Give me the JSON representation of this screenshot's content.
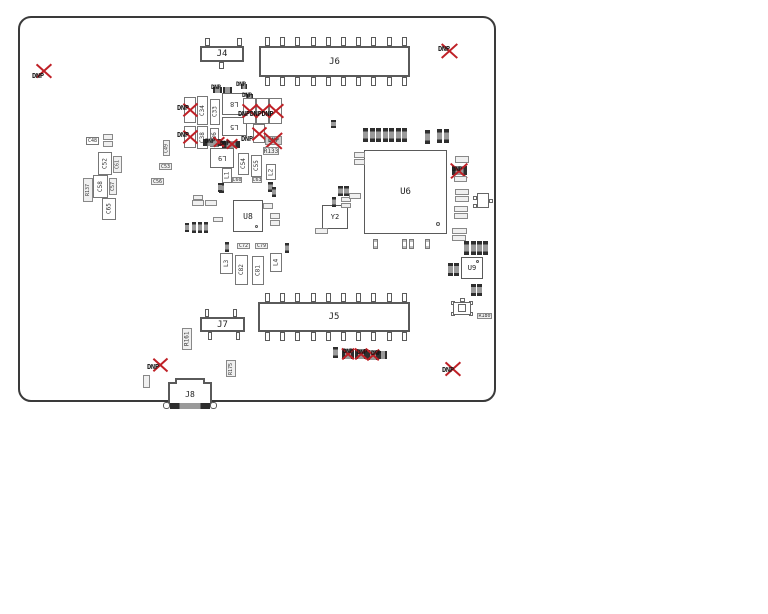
{
  "drawing": {
    "dnp": "DNP",
    "dnp_triple": "DNPDNPDNP",
    "refs": {
      "J4": "J4",
      "J5": "J5",
      "J6": "J6",
      "J7": "J7",
      "J8": "J8",
      "U6": "U6",
      "U8": "U8",
      "U9": "U9",
      "Y2": "Y2",
      "L1": "L1",
      "L2": "L2",
      "L3": "L3",
      "L4": "L4",
      "L5": "L5",
      "L8": "L8",
      "L9": "L9",
      "C33": "C33",
      "C34": "C34",
      "C36": "C36",
      "C38": "C38",
      "C48": "C48",
      "C49": "C49",
      "C52": "C52",
      "C53": "C53",
      "C54": "C54",
      "C55": "C55",
      "C56": "C56",
      "C57": "C57",
      "C58": "C58",
      "C60": "C60",
      "C61": "C61",
      "C63": "C63",
      "C65": "C65",
      "C72": "C72",
      "C79": "C79",
      "C81": "C81",
      "C82": "C82",
      "R133": "R133",
      "R137": "R137",
      "R161": "R161",
      "R175": "R175",
      "R180": "R180"
    },
    "symbols": {
      "pin1_asterisk": "*"
    },
    "colors": {
      "board_outline": "#3a3a3a",
      "part_outline": "#777777",
      "dnp_red": "#bf2026",
      "silk_text": "#222222",
      "dark_part": "#2e2e2e"
    }
  }
}
